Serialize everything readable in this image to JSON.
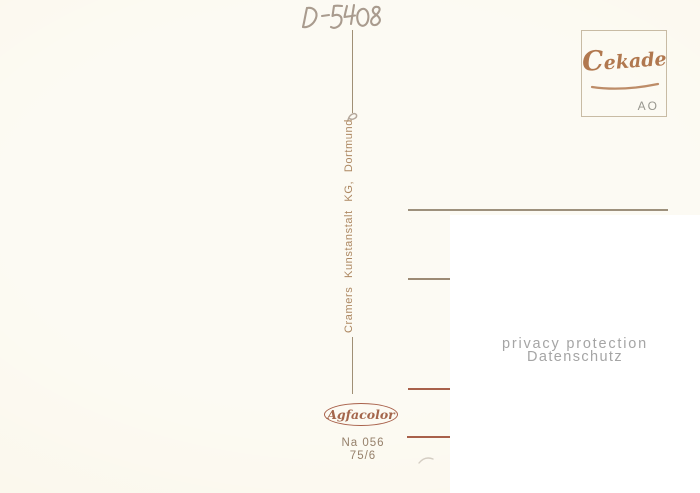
{
  "postcard": {
    "handwritten_code": "D-5408",
    "publisher_imprint": "Cramers  Kunstanstalt  KG,  Dortmund",
    "stamp_box": {
      "brand": "Cekade",
      "corner_label": "AO"
    },
    "privacy_overlay": {
      "line1": "privacy protection",
      "line2": "Datenschutz"
    },
    "film_logo": "Agfacolor",
    "catalog_number": "Na 056",
    "series_number": "75/6",
    "colors": {
      "background": "#fbf8ed",
      "ink_brown": "#ad8862",
      "line_rust": "#a8604a",
      "line_gray": "#9d907c",
      "logo_brown": "#b1784f",
      "handwriting": "#a29486",
      "privacy_gray": "#a5a5a5",
      "overlay_white": "#ffffff"
    }
  }
}
